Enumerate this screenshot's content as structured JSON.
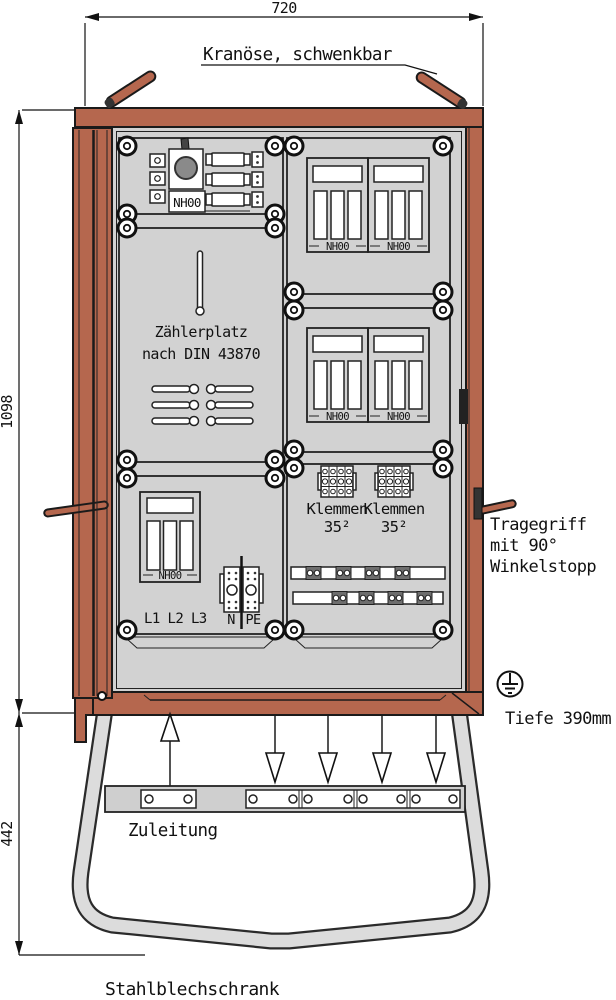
{
  "sheet": {
    "title": "Stahlblechschrank"
  },
  "dimensions": {
    "width": "720",
    "cabinet_height": "1098",
    "base_height": "442",
    "depth": "Tiefe 390mm"
  },
  "annotations": {
    "crane_eye": "Kranöse, schwenkbar",
    "handle_line1": "Tragegriff",
    "handle_line2": "mit 90°",
    "handle_line3": "Winkelstopp",
    "supply": "Zuleitung"
  },
  "components": {
    "fuse_label": "NH00",
    "meter_line1": "Zählerplatz",
    "meter_line2": "nach DIN 43870",
    "terminals_line1": "Klemmen",
    "terminals_line2": "35²",
    "phases": "L1 L2 L3",
    "neutral": "N",
    "protective_earth": "PE"
  },
  "colors": {
    "cabinet_red": "#b5674e",
    "interior_gray": "#d2d2d2",
    "stand_gray": "#dcdcdc",
    "outline": "#1a1a1a"
  }
}
